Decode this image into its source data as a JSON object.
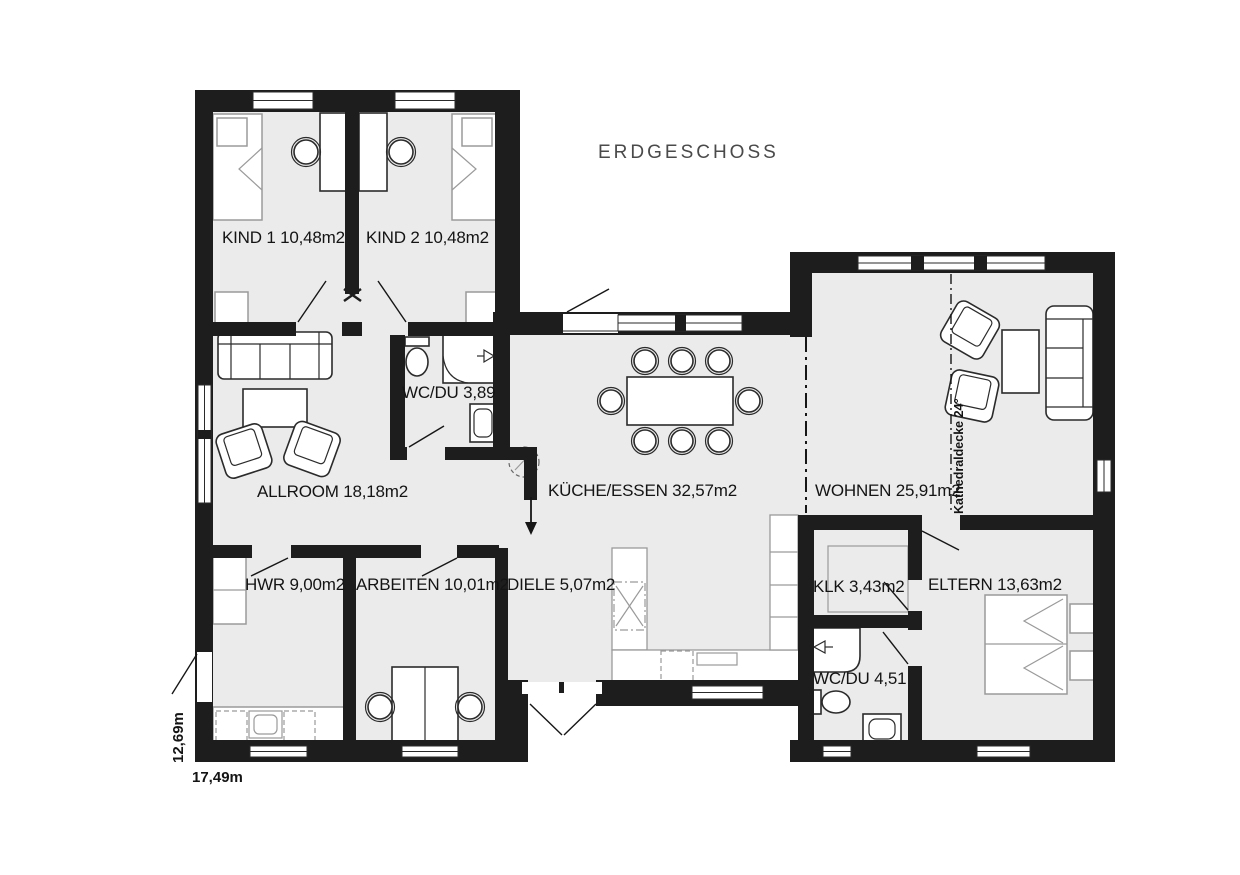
{
  "title": "ERDGESCHOSS",
  "floor_plan": {
    "rooms": [
      {
        "id": "kind1",
        "label": "KIND 1 10,48m2"
      },
      {
        "id": "kind2",
        "label": "KIND 2 10,48m2"
      },
      {
        "id": "wc_du_og",
        "label": "WC/DU 3,89"
      },
      {
        "id": "allroom",
        "label": "ALLROOM 18,18m2"
      },
      {
        "id": "kueche",
        "label": "KÜCHE/ESSEN 32,57m2"
      },
      {
        "id": "wohnen",
        "label": "WOHNEN 25,91m2"
      },
      {
        "id": "hwr",
        "label": "HWR 9,00m2"
      },
      {
        "id": "arbeiten",
        "label": "ARBEITEN 10,01m2"
      },
      {
        "id": "diele",
        "label": "DIELE 5,07m2"
      },
      {
        "id": "klk",
        "label": "KLK 3,43m2"
      },
      {
        "id": "eltern",
        "label": "ELTERN 13,63m2"
      },
      {
        "id": "wc_du_eg",
        "label": "WC/DU 4,51"
      }
    ],
    "annotations": {
      "kathedraldecke": "Kathedraldecke 24°"
    },
    "dimensions": {
      "width_label": "17,49m",
      "height_label": "12,69m"
    },
    "colors": {
      "wall": "#1d1d1d",
      "floor": "#ebebeb"
    }
  }
}
